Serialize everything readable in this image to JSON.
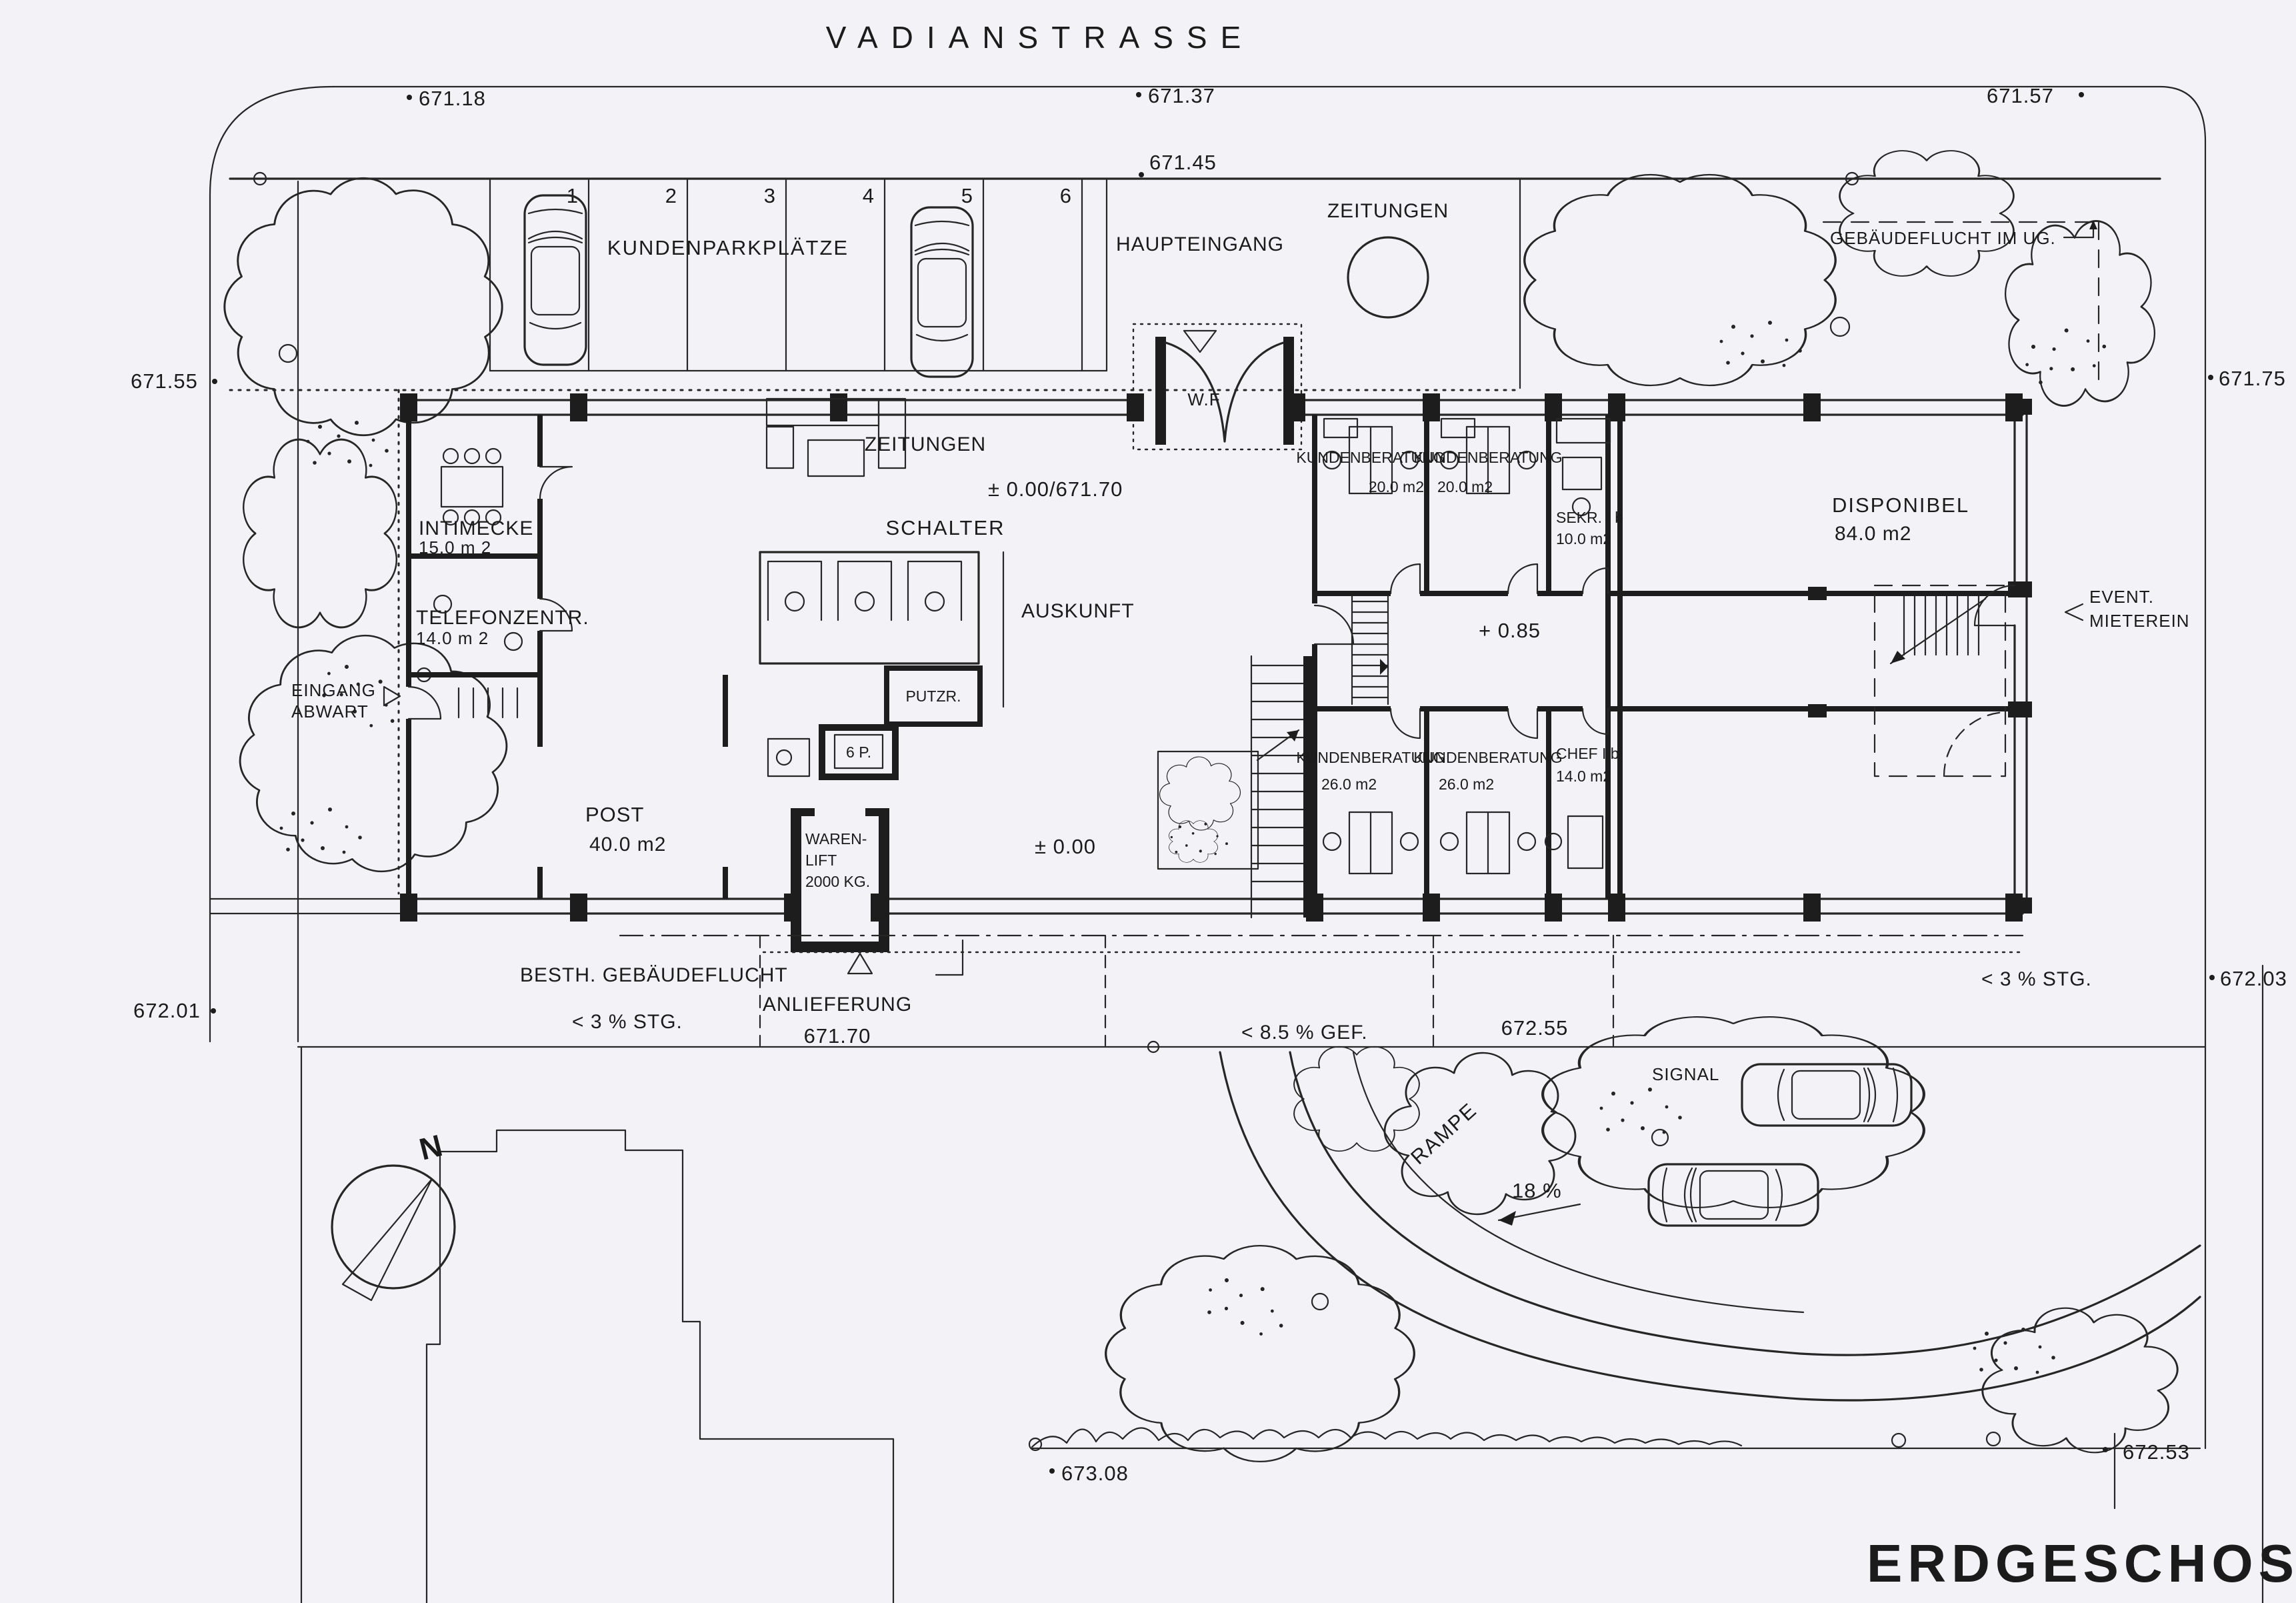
{
  "plan": {
    "street_name": "VADIANSTRASSE",
    "title": "ERDGESCHOSS",
    "north_label": "N"
  },
  "parking": {
    "label": "KUNDENPARKPLÄTZE",
    "stalls": [
      "1",
      "2",
      "3",
      "4",
      "5",
      "6"
    ]
  },
  "entrances": {
    "main": "HAUPTEINGANG",
    "vestibule": "W.F",
    "caretaker_line1": "EINGANG",
    "caretaker_line2": "ABWART",
    "tenant_line1": "EVENT.",
    "tenant_line2": "MIETEREIN",
    "delivery": "ANLIEFERUNG"
  },
  "kiosk": {
    "label": "ZEITUNGEN"
  },
  "rooms": {
    "zeitungen": "ZEITUNGEN",
    "schalter": "SCHALTER",
    "auskunft": "AUSKUNFT",
    "putzraum": "PUTZR.",
    "lift": "6 P.",
    "warenlift_line1": "WAREN-",
    "warenlift_line2": "LIFT",
    "warenlift_line3": "2000 KG.",
    "intimecke": {
      "name": "INTIMECKE",
      "area": "15.0 m 2"
    },
    "telefonzentrale": {
      "name": "TELEFONZENTR.",
      "area": "14.0 m 2"
    },
    "post": {
      "name": "POST",
      "area": "40.0 m2"
    },
    "kb_top_left": {
      "name": "KUNDENBERATUNG",
      "area": "20.0 m2"
    },
    "kb_top_right": {
      "name": "KUNDENBERATUNG",
      "area": "20.0 m2"
    },
    "sekretariat": {
      "name": "SEKR. I b",
      "area": "10.0 m2"
    },
    "disponibel": {
      "name": "DISPONIBEL",
      "area": "84.0 m2"
    },
    "kb_bottom_left": {
      "name": "KUNDENBERATUNG",
      "area": "26.0 m2"
    },
    "kb_bottom_right": {
      "name": "KUNDENBERATUNG",
      "area": "26.0 m2"
    },
    "chef": {
      "name": "CHEF I b",
      "area": "14.0 m2"
    }
  },
  "levels": {
    "entry": "± 0.00/671.70",
    "hall": "± 0.00",
    "corridor": "+ 0.85"
  },
  "site": {
    "building_line_ug": "GEBÄUDEFLUCHT IM UG.",
    "existing_building_line": "BESTH. GEBÄUDEFLUCHT",
    "slope_west": "< 3 % STG.",
    "slope_mid": "< 8.5 % GEF.",
    "slope_east": "< 3 % STG.",
    "ramp": "RAMPE",
    "ramp_slope": "18 %",
    "signal": "SIGNAL"
  },
  "elevations": {
    "nw": "671.18",
    "n1": "671.37",
    "n2": "671.45",
    "ne": "671.57",
    "w1": "671.55",
    "e1": "671.75",
    "w2": "672.01",
    "e2": "672.03",
    "delivery": "671.70",
    "mid": "672.55",
    "s1": "673.08",
    "s2": "672.53"
  }
}
